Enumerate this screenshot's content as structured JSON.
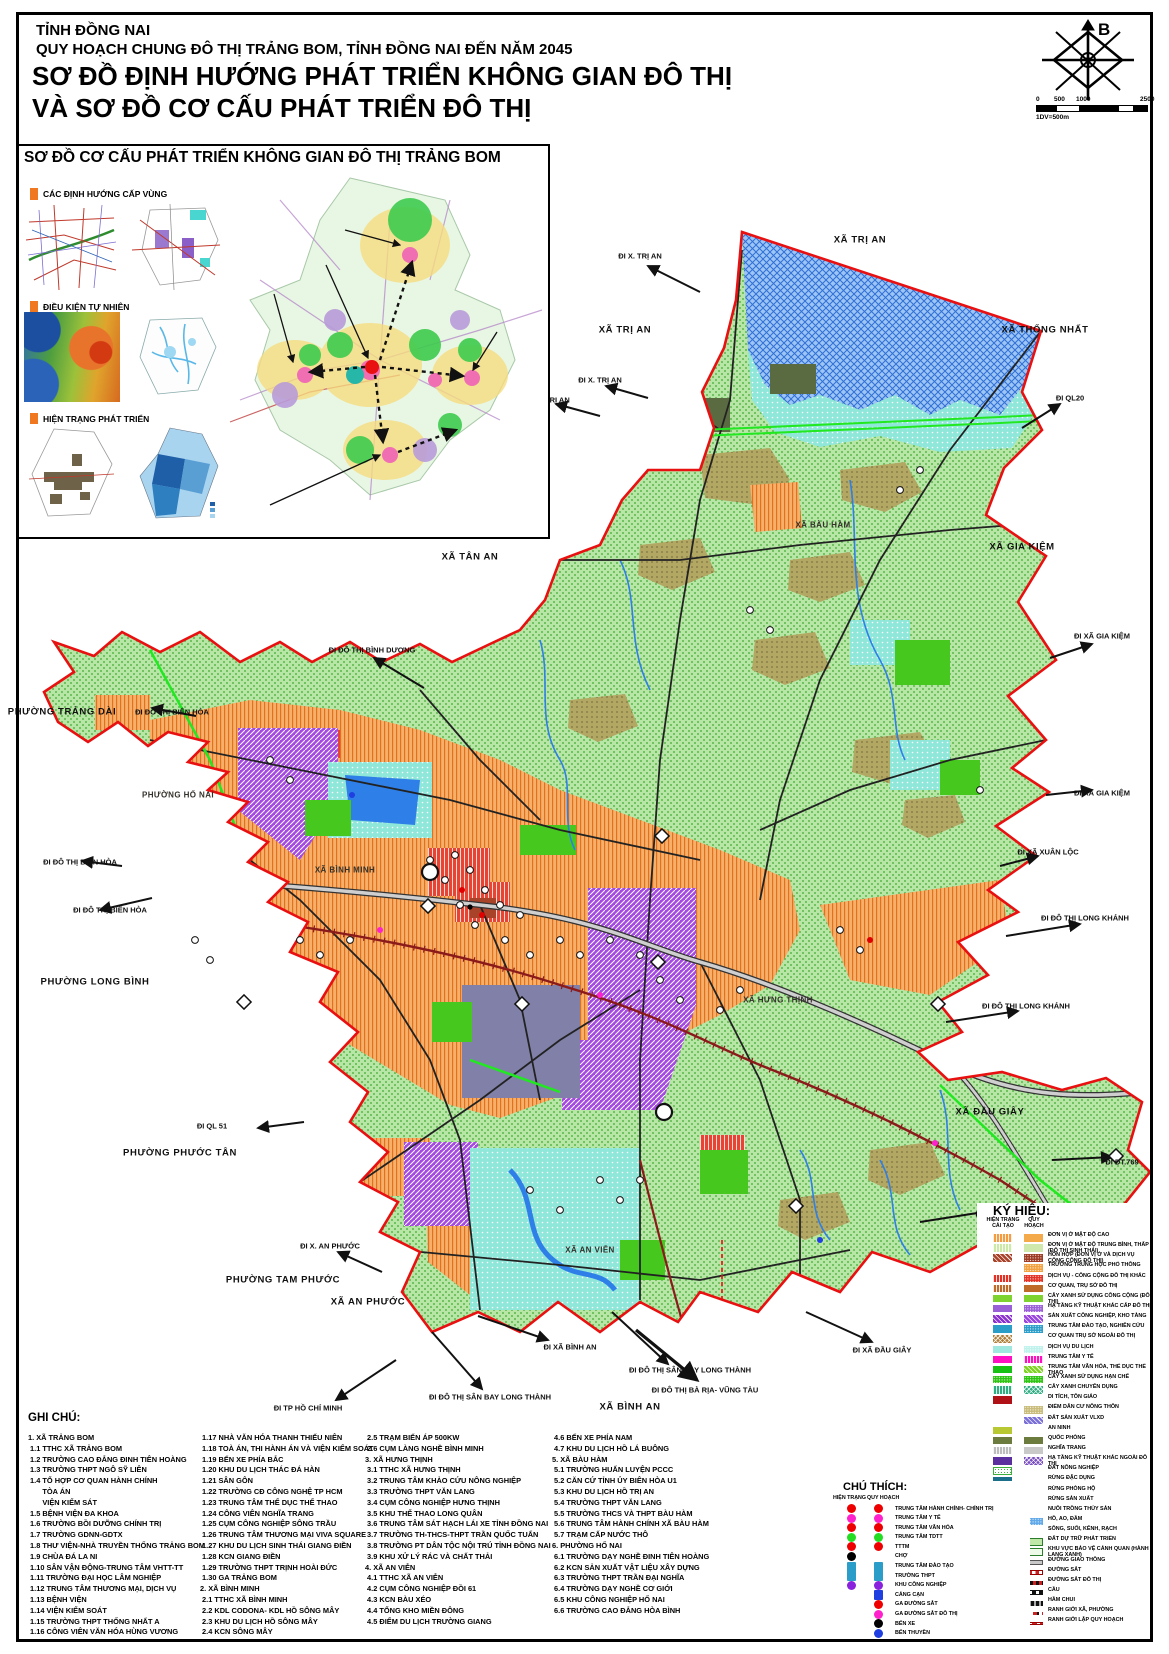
{
  "header": {
    "line1": "TỈNH ĐỒNG NAI",
    "line2": "QUY HOẠCH CHUNG ĐÔ THỊ TRẢNG BOM, TỈNH ĐỒNG NAI ĐẾN NĂM 2045",
    "line3": "SƠ ĐỒ ĐỊNH HƯỚNG PHÁT TRIỂN KHÔNG GIAN ĐÔ THỊ",
    "line4": "VÀ SƠ ĐỒ CƠ CẤU PHÁT TRIỂN ĐÔ THỊ"
  },
  "compass": {
    "north": "B"
  },
  "scale": {
    "ticks": [
      "0",
      "500",
      "1000",
      "2500"
    ],
    "note": "1DV=500m"
  },
  "inset": {
    "title": "SƠ ĐỒ CƠ CẤU PHÁT TRIỂN KHÔNG GIAN ĐÔ THỊ TRẢNG BOM",
    "sections": [
      "CÁC ĐỊNH HƯỚNG CẤP VÙNG",
      "ĐIỀU KIỆN TỰ NHIÊN",
      "HIỆN TRẠNG PHÁT TRIỂN"
    ],
    "zone_labels": [
      {
        "t": "KHU VỰC PHÍA BẮC",
        "x": 343,
        "y": 220
      },
      {
        "t": "KHU VỰC TRUNG TÂM",
        "x": 324,
        "y": 255
      },
      {
        "t": "KHU VỰC PHÍA TÂY",
        "x": 272,
        "y": 284
      },
      {
        "t": "KHU VỰC PHÍA ĐÔNG",
        "x": 495,
        "y": 322
      },
      {
        "t": "KHU VỰC PHÍA NAM",
        "x": 272,
        "y": 503
      }
    ],
    "route_badges": [
      {
        "t": "762",
        "x": 503,
        "y": 222,
        "s": "d"
      },
      {
        "t": "56B",
        "x": 489,
        "y": 287,
        "s": "c"
      },
      {
        "t": "767",
        "x": 328,
        "y": 330,
        "s": "d"
      },
      {
        "t": "777",
        "x": 402,
        "y": 363,
        "s": "d"
      },
      {
        "t": "QL1",
        "x": 317,
        "y": 383,
        "s": "c"
      },
      {
        "t": "769",
        "x": 292,
        "y": 447,
        "s": "d"
      }
    ],
    "road_names": [
      {
        "t": "Đ. VÕ NGUYÊN GIÁP",
        "x": 255,
        "y": 430,
        "r": -38
      }
    ]
  },
  "map": {
    "labels": [
      {
        "t": "XÃ TRỊ AN",
        "x": 860,
        "y": 240,
        "c": "a"
      },
      {
        "t": "XÃ TRỊ AN",
        "x": 625,
        "y": 330,
        "c": "a"
      },
      {
        "t": "XÃ THỐNG NHẤT",
        "x": 1045,
        "y": 330,
        "c": "a"
      },
      {
        "t": "ĐI X. TRỊ AN",
        "x": 640,
        "y": 256,
        "c": "d"
      },
      {
        "t": "ĐI X. TRỊ AN",
        "x": 600,
        "y": 380,
        "c": "d"
      },
      {
        "t": "ĐI X. TRỊ AN",
        "x": 548,
        "y": 400,
        "c": "d"
      },
      {
        "t": "ĐI QL20",
        "x": 1070,
        "y": 398,
        "c": "d"
      },
      {
        "t": "XÃ GIA KIỆM",
        "x": 1022,
        "y": 547,
        "c": "a"
      },
      {
        "t": "ĐI XÃ GIA KIỆM",
        "x": 1102,
        "y": 636,
        "c": "d"
      },
      {
        "t": "ĐI XÃ GIA KIỆM",
        "x": 1102,
        "y": 793,
        "c": "d"
      },
      {
        "t": "ĐI XÃ XUÂN LỘC",
        "x": 1048,
        "y": 852,
        "c": "d"
      },
      {
        "t": "ĐI ĐÔ THỊ LONG KHÁNH",
        "x": 1085,
        "y": 918,
        "c": "d"
      },
      {
        "t": "ĐI ĐÔ THỊ LONG KHÁNH",
        "x": 1026,
        "y": 1006,
        "c": "d"
      },
      {
        "t": "XÃ ĐẦU GIÂY",
        "x": 990,
        "y": 1112,
        "c": "a"
      },
      {
        "t": "ĐI ĐT.769",
        "x": 1122,
        "y": 1162,
        "c": "d"
      },
      {
        "t": "ĐI X.ĐẦU GIÂY",
        "x": 1002,
        "y": 1214,
        "c": "d"
      },
      {
        "t": "ĐI ĐT.769",
        "x": 1122,
        "y": 1285,
        "c": "d"
      },
      {
        "t": "ĐI XÃ ĐẦU GIÂY",
        "x": 882,
        "y": 1350,
        "c": "d"
      },
      {
        "t": "ĐI ĐÔ THỊ SÂN BAY LONG THÀNH",
        "x": 690,
        "y": 1370,
        "c": "d"
      },
      {
        "t": "ĐI ĐÔ THỊ BÀ RỊA- VŨNG TÀU",
        "x": 705,
        "y": 1390,
        "c": "d"
      },
      {
        "t": "XÃ BÌNH AN",
        "x": 630,
        "y": 1407,
        "c": "a"
      },
      {
        "t": "ĐI ĐÔ THỊ SÂN BAY LONG THÀNH",
        "x": 490,
        "y": 1397,
        "c": "d"
      },
      {
        "t": "ĐI XÃ BÌNH AN",
        "x": 570,
        "y": 1347,
        "c": "d"
      },
      {
        "t": "XÃ AN PHƯỚC",
        "x": 368,
        "y": 1302,
        "c": "a"
      },
      {
        "t": "ĐI X. AN PHƯỚC",
        "x": 330,
        "y": 1246,
        "c": "d"
      },
      {
        "t": "ĐI TP HỒ CHÍ MINH",
        "x": 308,
        "y": 1408,
        "c": "d"
      },
      {
        "t": "PHƯỜNG TAM PHƯỚC",
        "x": 283,
        "y": 1280,
        "c": "a"
      },
      {
        "t": "PHƯỜNG PHƯỚC TÂN",
        "x": 180,
        "y": 1153,
        "c": "a"
      },
      {
        "t": "ĐI QL 51",
        "x": 212,
        "y": 1126,
        "c": "d"
      },
      {
        "t": "PHƯỜNG LONG BÌNH",
        "x": 95,
        "y": 982,
        "c": "a"
      },
      {
        "t": "ĐI ĐÔ THỊ BIÊN HÒA",
        "x": 110,
        "y": 910,
        "c": "d"
      },
      {
        "t": "ĐI ĐÔ THỊ BIÊN HÒA",
        "x": 80,
        "y": 862,
        "c": "d"
      },
      {
        "t": "ĐI ĐÔ THỊ BIÊN HÒA",
        "x": 172,
        "y": 712,
        "c": "d"
      },
      {
        "t": "PHƯỜNG TRẢNG DÀI",
        "x": 62,
        "y": 712,
        "c": "a"
      },
      {
        "t": "ĐI ĐÔ THỊ BÌNH DƯƠNG",
        "x": 372,
        "y": 650,
        "c": "d"
      },
      {
        "t": "XÃ TÂN AN",
        "x": 470,
        "y": 557,
        "c": "a"
      },
      {
        "t": "XÃ BÀU HÀM",
        "x": 823,
        "y": 525,
        "c": "i"
      },
      {
        "t": "PHƯỜNG HỐ NAI",
        "x": 178,
        "y": 795,
        "c": "i"
      },
      {
        "t": "XÃ BÌNH MINH",
        "x": 345,
        "y": 870,
        "c": "i"
      },
      {
        "t": "XÃ HƯNG THỊNH",
        "x": 778,
        "y": 1000,
        "c": "i"
      },
      {
        "t": "XÃ AN VIỄN",
        "x": 590,
        "y": 1250,
        "c": "i"
      }
    ]
  },
  "legend": {
    "title": "KÝ HIỆU:",
    "col_ht": "HIỆN TRẠNG",
    "col_ht2": "CẢI TẠO",
    "col_qh": "QUY HOẠCH",
    "items": [
      {
        "l": "ĐƠN VỊ Ở MẬT ĐỘ CAO",
        "h": {
          "c": "#f49c42",
          "p": "vh"
        },
        "q": {
          "c": "#f4a94b",
          "p": "s"
        }
      },
      {
        "l": "ĐƠN VỊ Ở MẬT ĐỘ TRUNG BÌNH, THẤP (ĐÔ THỊ SINH THÁI)",
        "h": {
          "c": "#cde9a8",
          "p": "vh"
        },
        "q": {
          "c": "#cfe9ad",
          "p": "s"
        }
      },
      {
        "l": "HỖN HỢP (ĐƠN VỊ Ở VÀ DỊCH VỤ CÔNG CỘNG ĐÔ THỊ)",
        "h": {
          "c": "#a8432a",
          "p": "dh"
        },
        "q": {
          "c": "#9c3a22",
          "p": "dt"
        }
      },
      {
        "l": "TRƯỜNG TRUNG HỌC PHỔ THÔNG",
        "h": null,
        "q": {
          "c": "#f2a13e",
          "p": "dt"
        }
      },
      {
        "l": "DỊCH VỤ - CÔNG CỘNG ĐÔ THỊ KHÁC",
        "h": {
          "c": "#e33225",
          "p": "vh"
        },
        "q": {
          "c": "#e33225",
          "p": "dt"
        }
      },
      {
        "l": "CƠ QUAN, TRỤ SỞ ĐÔ THỊ",
        "h": {
          "c": "#c06a2a",
          "p": "vh"
        },
        "q": {
          "c": "#c06a2a",
          "p": "s"
        }
      },
      {
        "l": "CÂY XANH SỬ DỤNG CÔNG CỘNG (ĐÔ THỊ)",
        "h": {
          "c": "#7fd32e",
          "p": "s"
        },
        "q": {
          "c": "#7fd32e",
          "p": "s"
        }
      },
      {
        "l": "HẠ TẦNG KỸ THUẬT KHÁC CẤP ĐÔ THỊ",
        "h": {
          "c": "#9a5fd6",
          "p": "s"
        },
        "q": {
          "c": "#9a5fd6",
          "p": "dt"
        }
      },
      {
        "l": "SẢN XUẤT CÔNG NGHIỆP, KHO TÀNG",
        "h": {
          "c": "#8b2fd0",
          "p": "dh"
        },
        "q": {
          "c": "#9a44e0",
          "p": "dh"
        }
      },
      {
        "l": "TRUNG TÂM ĐÀO TẠO, NGHIÊN CỨU",
        "h": {
          "c": "#2b9dc9",
          "p": "s"
        },
        "q": {
          "c": "#2b9dc9",
          "p": "dt"
        }
      },
      {
        "l": "CƠ QUAN TRỤ SỞ NGOÀI ĐÔ THỊ",
        "h": {
          "c": "#b07f3a",
          "p": "xh"
        },
        "q": null
      },
      {
        "l": "DỊCH VỤ DU LỊCH",
        "h": {
          "c": "#9fe8df",
          "p": "s"
        },
        "q": {
          "c": "#bff2ec",
          "p": "dt"
        }
      },
      {
        "l": "TRUNG TÂM Y TẾ",
        "h": {
          "c": "#ff10c0",
          "p": "s"
        },
        "q": {
          "c": "#ff10c0",
          "p": "vh"
        }
      },
      {
        "l": "TRUNG TÂM VĂN HÓA,  THỂ DỤC THỂ THAO",
        "h": {
          "c": "#18c214",
          "p": "s"
        },
        "q": {
          "c": "#7ed321",
          "p": "dh"
        }
      },
      {
        "l": "CÂY XANH SỬ DỤNG HẠN CHẾ",
        "h": {
          "c": "#2ec412",
          "p": "dt"
        },
        "q": {
          "c": "#2ec412",
          "p": "dt"
        }
      },
      {
        "l": "CÂY XANH CHUYÊN DỤNG",
        "h": {
          "c": "#2fae84",
          "p": "vh"
        },
        "q": {
          "c": "#2fae84",
          "p": "xh"
        }
      },
      {
        "l": "DI TÍCH, TÔN GIÁO",
        "h": {
          "c": "#b01116",
          "p": "s"
        },
        "q": null
      },
      {
        "l": "ĐIỂM DÂN CƯ NÔNG THÔN",
        "h": null,
        "q": {
          "c": "#c9bc7a",
          "p": "dt"
        }
      },
      {
        "l": "ĐẤT SẢN XUẤT VLXD",
        "h": null,
        "q": {
          "c": "#7a6fd8",
          "p": "dh"
        }
      },
      {
        "l": "AN NINH",
        "h": {
          "c": "#b7c832",
          "p": "s"
        },
        "q": null
      },
      {
        "l": "QUỐC PHÒNG",
        "h": {
          "c": "#6b7c3e",
          "p": "s"
        },
        "q": {
          "c": "#6b7c3e",
          "p": "s"
        }
      },
      {
        "l": "NGHĨA TRANG",
        "h": {
          "c": "#bdbdbd",
          "p": "vh"
        },
        "q": {
          "c": "#c9c9c9",
          "p": "s"
        }
      },
      {
        "l": "HẠ TẦNG KỸ THUẬT KHÁC NGOÀI ĐÔ THỊ",
        "h": {
          "c": "#5b2f9e",
          "p": "s"
        },
        "q": {
          "c": "#7a4fc0",
          "p": "xh"
        }
      },
      {
        "l": "ĐẤT NÔNG NGHIỆP",
        "h": {
          "c": "#ffffff",
          "p": "agr"
        },
        "q": null
      },
      {
        "l": "RỪNG ĐẶC DỤNG",
        "h": {
          "c": "#1b6f8a",
          "p": "s"
        },
        "q": null
      },
      {
        "l": "RỪNG PHÒNG HỘ",
        "h": {
          "c": "#8aa47a",
          "p": "xh"
        },
        "q": null
      },
      {
        "l": "RỪNG SẢN XUẤT",
        "h": {
          "c": "#59a05c",
          "p": "s"
        },
        "q": null
      },
      {
        "l": "NUÔI TRỒNG THỦY SẢN",
        "h": {
          "c": "#79b8f2",
          "p": "dt"
        },
        "q": null
      },
      {
        "l": "HỒ, AO, ĐẦM",
        "h": {
          "c": "#1f6fd0",
          "p": "xh"
        },
        "q": {
          "c": "#5fa8e8",
          "p": "dt"
        }
      },
      {
        "l": "SÔNG, SUỐI, KÊNH, RẠCH",
        "h": {
          "c": "#1f78e0",
          "p": "s"
        },
        "q": null
      },
      {
        "l": "ĐẤT DỰ TRỮ PHÁT TRIỂN",
        "h": null,
        "q": {
          "c": "#bfe8a8",
          "p": "out"
        }
      },
      {
        "l": "KHU VỰC BẢO VỆ CẢNH QUAN (HÀNH LANG XANH)",
        "h": null,
        "q": {
          "c": "#eefbe8",
          "p": "out"
        }
      },
      {
        "l": "ĐƯỜNG GIAO THÔNG",
        "h": {
          "c": "#c8c8c8",
          "p": "bar"
        },
        "q": {
          "c": "#c8c8c8",
          "p": "bar"
        }
      },
      {
        "l": "ĐƯỜNG SẮT",
        "h": {
          "c": "#cc2222",
          "p": "rail"
        },
        "q": {
          "c": "#cc2222",
          "p": "rail"
        }
      },
      {
        "l": "ĐƯỜNG SẮT ĐÔ THỊ",
        "h": null,
        "q": {
          "c": "#cc2222",
          "p": "railm"
        }
      },
      {
        "l": "CẦU",
        "h": null,
        "q": {
          "c": "#111111",
          "p": "bridge"
        }
      },
      {
        "l": "HẦM CHUI",
        "h": null,
        "q": {
          "c": "#111111",
          "p": "tunnel"
        }
      },
      {
        "l": "RANH GIỚI XÃ, PHƯỜNG",
        "h": null,
        "q": {
          "c": "#cc2222",
          "p": "bdry1"
        }
      },
      {
        "l": "RANH GIỚI LẬP QUY HOẠCH",
        "h": null,
        "q": {
          "c": "#cc2222",
          "p": "bdry2"
        }
      }
    ]
  },
  "notes": {
    "title": "GHI CHÚ:",
    "columns": [
      [
        "1. XÃ TRẢNG BOM",
        " 1.1 TTHC XÃ TRẢNG BOM",
        " 1.2 TRƯỜNG CAO ĐẲNG ĐINH TIÊN HOÀNG",
        " 1.3 TRƯỜNG THPT NGÔ SỸ LIÊN",
        " 1.4 TỔ HỢP CƠ QUAN HÀNH CHÍNH",
        "       TÒA ÁN",
        "       VIỆN KIỂM SÁT",
        " 1.5 BỆNH VIỆN ĐA KHOA",
        " 1.6 TRƯỜNG BỒI DƯỠNG CHÍNH TRỊ",
        " 1.7 TRƯỜNG GDNN-GDTX",
        " 1.8 THƯ VIỆN-NHÀ TRUYỀN THỐNG TRẢNG BOM",
        " 1.9 CHÙA ĐÁ LA NI",
        " 1.10 SÂN VẬN ĐỘNG-TRUNG TÂM VHTT-TT",
        " 1.11 TRƯỜNG ĐẠI HỌC LÂM NGHIỆP",
        " 1.12 TRUNG TÂM THƯƠNG MẠI, DỊCH VỤ",
        " 1.13 BỆNH VIỆN",
        " 1.14 VIỆN KIỂM SOÁT",
        " 1.15 TRƯỜNG THPT THỐNG NHẤT A",
        " 1.16 CÔNG VIÊN VĂN HÓA HÙNG VƯƠNG"
      ],
      [
        " 1.17 NHÀ VĂN HÓA THANH THIẾU NIÊN",
        " 1.18 TOÀ ÁN, THI HÀNH ÁN VÀ VIỆN KIỂM SOÁT",
        " 1.19 BẾN XE PHÍA BẮC",
        " 1.20 KHU DU LỊCH THÁC ĐÁ HÀN",
        " 1.21 SÂN GÔN",
        " 1.22 TRƯỜNG CĐ CÔNG NGHỆ TP HCM",
        " 1.23 TRUNG TÂM THỂ DỤC THỂ THAO",
        " 1.24 CÔNG VIÊN NGHĨA TRANG",
        " 1.25 CỤM CÔNG NGHIỆP SÔNG TRẦU",
        " 1.26 TRUNG TÂM THƯƠNG MẠI VIVA SQUARE",
        " 1.27 KHU DU LỊCH SINH THÁI GIANG ĐIỀN",
        " 1.28 KCN GIANG ĐIỀN",
        " 1.29 TRƯỜNG THPT TRỊNH HOÀI ĐỨC",
        " 1.30 GA TRẢNG BOM",
        "2. XÃ BÌNH MINH",
        " 2.1 TTHC XÃ BÌNH MINH",
        " 2.2 KDL CODONA- KDL HỒ SÔNG MÂY",
        " 2.3 KHU DU LỊCH HỒ SÔNG MÂY",
        " 2.4 KCN SÔNG MÂY"
      ],
      [
        " 2.5 TRẠM BIẾN ÁP 500KW",
        " 2.6 CỤM LÀNG NGHỀ BÌNH MINH",
        "3. XÃ HƯNG THỊNH",
        " 3.1 TTHC XÃ HƯNG THỊNH",
        " 3.2 TRUNG TÂM KHẢO CỨU NÔNG NGHIỆP",
        " 3.3 TRƯỜNG THPT VĂN LANG",
        " 3.4 CỤM CÔNG NGHIỆP HƯNG THỊNH",
        " 3.5 KHU THỂ THAO LONG QUÂN",
        " 3.6 TRUNG TÂM SÁT HẠCH LÁI XE TỈNH ĐỒNG NAI",
        " 3.7 TRƯỜNG TH-THCS-THPT TRẦN QUỐC TUẤN",
        " 3.8 TRƯỜNG PT DÂN TỘC NỘI TRÚ TỈNH ĐỒNG NAI",
        " 3.9 KHU XỬ LÝ RÁC VÀ CHẤT THẢI",
        "4. XÃ AN VIỄN",
        " 4.1 TTHC XÃ AN VIỄN",
        " 4.2 CỤM CÔNG NGHIỆP ĐỒI 61",
        " 4.3 KCN BÀU XÉO",
        " 4.4 TỔNG KHO MIỀN ĐÔNG",
        " 4.5 ĐIỂM DU LỊCH TRƯỜNG GIANG"
      ],
      [
        " 4.6 BẾN XE PHÍA NAM",
        " 4.7 KHU DU LỊCH HỒ LÁ BUÔNG",
        "5. XÃ BÀU HÀM",
        " 5.1 TRƯỜNG HUẤN LUYỆN PCCC",
        " 5.2 CĂN CỨ TỈNH ỦY BIÊN HÒA U1",
        " 5.3 KHU DU LỊCH HỒ TRỊ AN",
        " 5.4 TRƯỜNG THPT VĂN LANG",
        " 5.5 TRƯỜNG THCS VÀ THPT BÀU HÀM",
        " 5.6 TRUNG TÂM HÀNH CHÍNH XÃ BÀU HÀM",
        " 5.7 TRẠM CẤP NƯỚC THÔ",
        "6. PHƯỜNG HỐ NAI",
        " 6.1 TRƯỜNG DẠY NGHỀ ĐINH TIÊN HOÀNG",
        " 6.2 KCN SẢN XUẤT VẬT LIỆU XÂY DỰNG",
        " 6.3 TRƯỜNG THPT TRẦN ĐẠI NGHĨA",
        " 6.4 TRƯỜNG DẠY NGHỀ CƠ GIỚI",
        " 6.5 KHU CÔNG NGHIỆP HỐ NAI",
        " 6.6 TRƯỜNG CAO ĐẲNG HÒA BÌNH"
      ]
    ]
  },
  "chuthich": {
    "title": "CHÚ THÍCH:",
    "col_ht": "HIỆN TRẠNG",
    "col_qh": "QUY HOẠCH",
    "items": [
      {
        "l": "TRUNG TÂM HÀNH CHÍNH- CHÍNH TRỊ",
        "h": {
          "s": "c",
          "c": "#ee0000"
        },
        "q": {
          "s": "c",
          "c": "#ee0000"
        }
      },
      {
        "l": "TRUNG TÂM Y TẾ",
        "h": {
          "s": "c",
          "c": "#ff22cc"
        },
        "q": {
          "s": "c",
          "c": "#ff22cc"
        }
      },
      {
        "l": "TRUNG TÂM VĂN HÓA",
        "h": {
          "s": "c",
          "c": "#ee0000"
        },
        "q": {
          "s": "c",
          "c": "#ee0000"
        }
      },
      {
        "l": "TRUNG TÂM TDTT",
        "h": {
          "s": "c",
          "c": "#22dd22"
        },
        "q": {
          "s": "c",
          "c": "#22dd22"
        }
      },
      {
        "l": "TTTM",
        "h": {
          "s": "c",
          "c": "#ee0000"
        },
        "q": {
          "s": "c",
          "c": "#ee0000"
        }
      },
      {
        "l": "CHỢ",
        "h": {
          "s": "c",
          "c": "#000000"
        },
        "q": null
      },
      {
        "l": "TRUNG TÂM ĐÀO TẠO",
        "h": {
          "s": "r",
          "c": "#2b9dc9"
        },
        "q": {
          "s": "r",
          "c": "#2b9dc9"
        }
      },
      {
        "l": "TRƯỜNG THPT",
        "h": {
          "s": "r",
          "c": "#2b9dc9"
        },
        "q": {
          "s": "r",
          "c": "#2b9dc9"
        }
      },
      {
        "l": "KHU CÔNG NGHIỆP",
        "h": {
          "s": "c",
          "c": "#8a22dd"
        },
        "q": {
          "s": "c",
          "c": "#8a22dd"
        }
      },
      {
        "l": "CẢNG CẠN",
        "h": null,
        "q": {
          "s": "r",
          "c": "#1f3fe0"
        }
      },
      {
        "l": "GA ĐƯỜNG SẮT",
        "h": null,
        "q": {
          "s": "c",
          "c": "#ee0000"
        }
      },
      {
        "l": "GA ĐƯỜNG SẮT ĐÔ THỊ",
        "h": null,
        "q": {
          "s": "c",
          "c": "#ff22cc"
        }
      },
      {
        "l": "BẾN XE",
        "h": null,
        "q": {
          "s": "c",
          "c": "#000000"
        }
      },
      {
        "l": "BẾN THUYỀN",
        "h": null,
        "q": {
          "s": "c",
          "c": "#1f3fe0"
        }
      }
    ]
  },
  "colors": {
    "boundary": "#e81010",
    "base_agriculture": "#b8e6a6",
    "water": "#2f7fe8",
    "urban_orange": "#f6b06a",
    "industry_purple": "#a44ae0",
    "tourism_teal": "#8fe7da",
    "expressway_green": "#22e822",
    "railway": "#8b1a1a"
  }
}
